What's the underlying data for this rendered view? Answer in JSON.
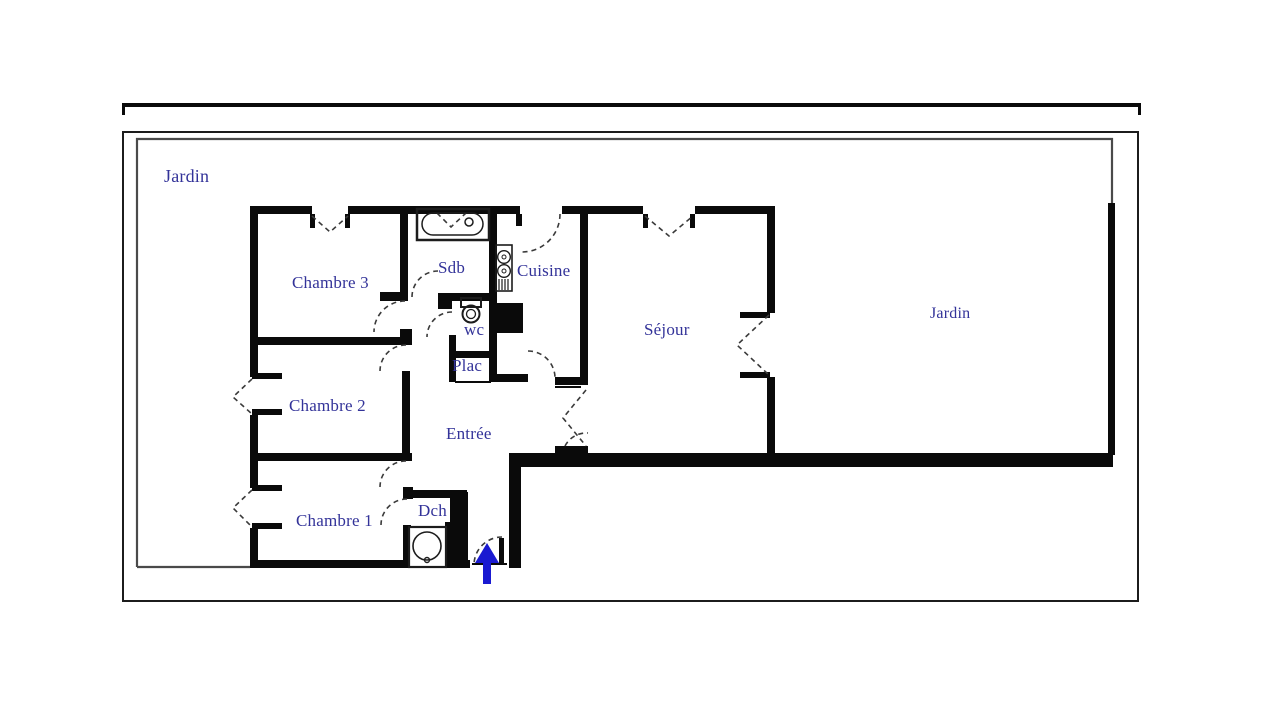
{
  "title": "Plan d'appartement",
  "labels": {
    "jardin_outer": "Jardin",
    "chambre3": "Chambre 3",
    "sdb": "Sdb",
    "cuisine": "Cuisine",
    "sejour": "Séjour",
    "jardin_right": "Jardin",
    "wc": "wc",
    "plac": "Plac",
    "chambre2": "Chambre 2",
    "entree": "Entrée",
    "chambre1": "Chambre 1",
    "dch": "Dch"
  },
  "icons": [
    "bathtub-icon",
    "toilet-icon",
    "kitchen-sink-icon",
    "shower-icon",
    "entrance-arrow-icon"
  ],
  "colors": {
    "bg": "#ffffff",
    "wall": "#0a0a0a",
    "label": "#333399",
    "arrow": "#1a1ad1",
    "fence": "#4a4a4a"
  }
}
